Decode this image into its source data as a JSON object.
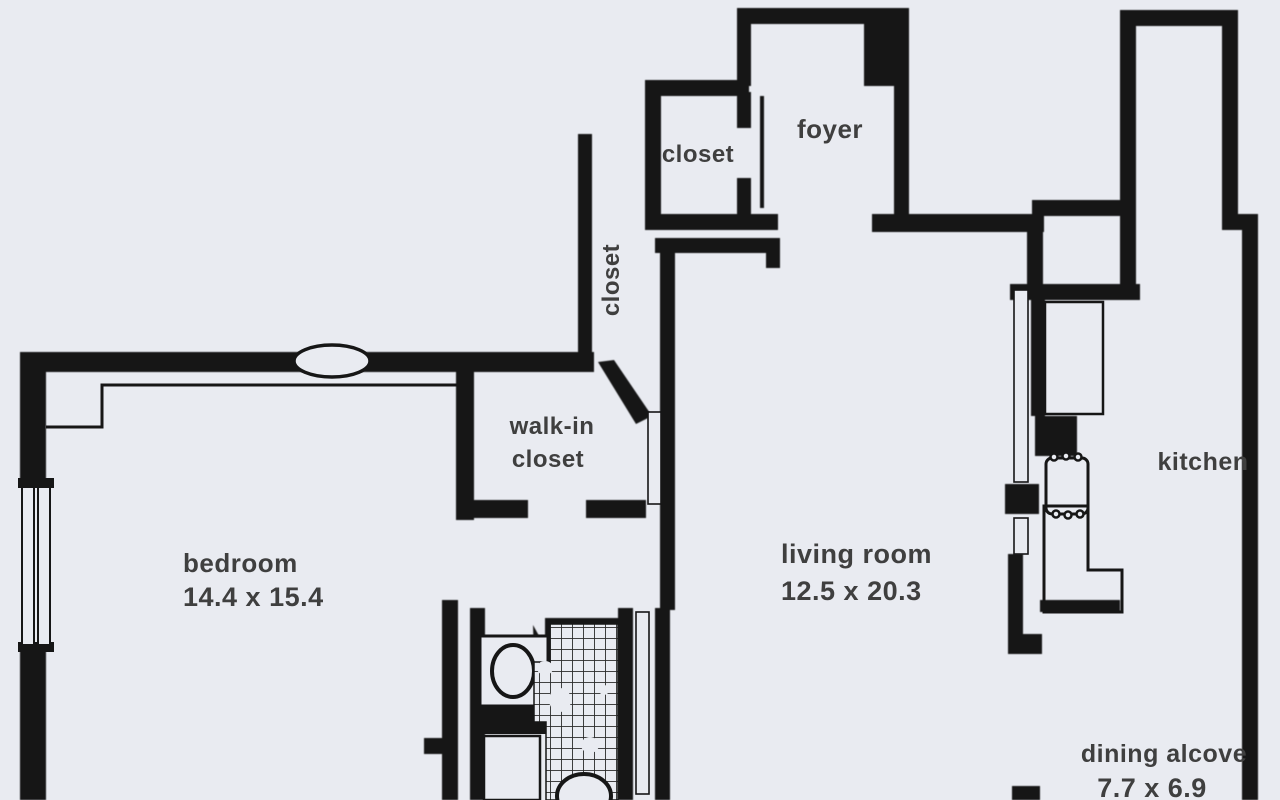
{
  "document_type": "apartment floor plan (scanned)",
  "colors": {
    "paper": "#e9ebf1",
    "wall": "#161616",
    "text": "#3f3f3f"
  },
  "rooms": {
    "foyer": {
      "label": "foyer"
    },
    "closet_top": {
      "label": "closet"
    },
    "closet_vertical": {
      "label": "closet"
    },
    "walk_in_closet": {
      "label_line1": "walk-in",
      "label_line2": "closet"
    },
    "bedroom": {
      "label": "bedroom",
      "dimensions": "14.4 x 15.4"
    },
    "living_room": {
      "label": "living room",
      "dimensions": "12.5 x 20.3"
    },
    "kitchen": {
      "label": "kitchen"
    },
    "dining_alcove": {
      "label": "dining alcove",
      "dimensions": "7.7 x 6.9"
    }
  }
}
